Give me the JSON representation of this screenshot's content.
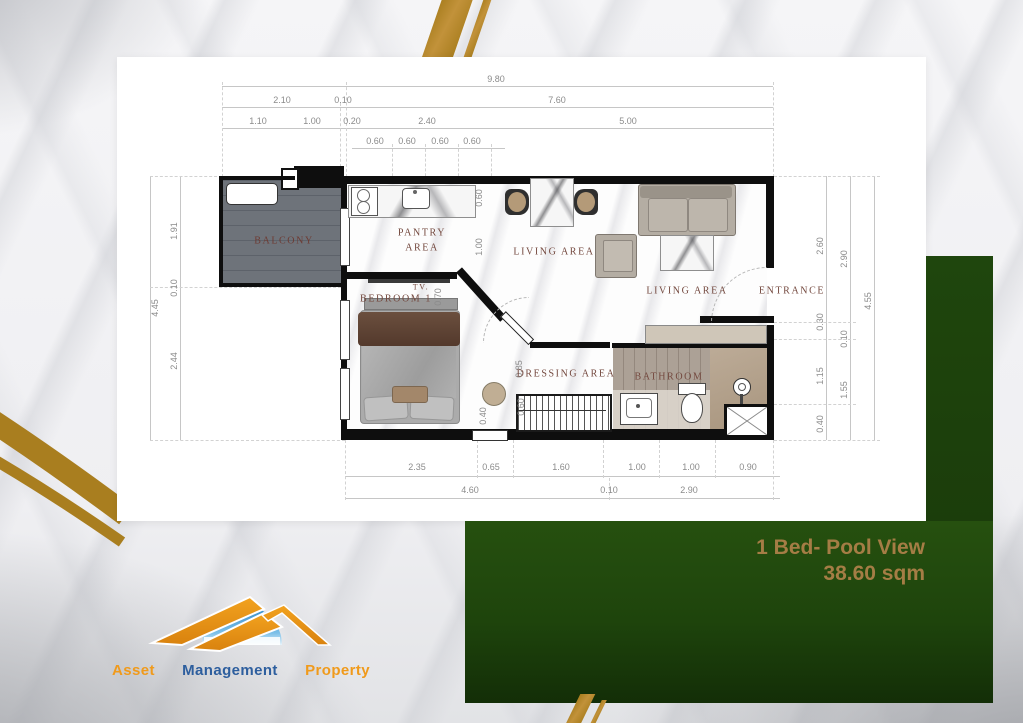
{
  "colors": {
    "gold": "#a97e1f",
    "green_dark": "#1e440c",
    "banner_text": "#a57d45",
    "label_text": "#74493f",
    "balcony_text": "#6d3b33",
    "logo_orange": "#f09a1b",
    "logo_blue": "#2d5e9e",
    "logo_sky": "#2f87c8"
  },
  "banner": {
    "line1": "1 Bed- Pool View",
    "line2": "38.60 sqm"
  },
  "logo": {
    "icon": "mountain-sun-logo",
    "words": [
      {
        "text": "Asset",
        "color": "#f09a1b"
      },
      {
        "text": "Management",
        "color": "#2d5e9e"
      },
      {
        "text": "Property",
        "color": "#f09a1b"
      }
    ]
  },
  "plan": {
    "dimensions": [
      {
        "v": "9.80",
        "x": 496,
        "y": 79,
        "vert": false
      },
      {
        "v": "2.10",
        "x": 282,
        "y": 100,
        "vert": false
      },
      {
        "v": "0.10",
        "x": 343,
        "y": 100,
        "vert": false
      },
      {
        "v": "7.60",
        "x": 557,
        "y": 100,
        "vert": false
      },
      {
        "v": "1.10",
        "x": 258,
        "y": 121,
        "vert": false
      },
      {
        "v": "1.00",
        "x": 312,
        "y": 121,
        "vert": false
      },
      {
        "v": "0.20",
        "x": 352,
        "y": 121,
        "vert": false
      },
      {
        "v": "2.40",
        "x": 427,
        "y": 121,
        "vert": false
      },
      {
        "v": "5.00",
        "x": 628,
        "y": 121,
        "vert": false
      },
      {
        "v": "0.60",
        "x": 375,
        "y": 141,
        "vert": false
      },
      {
        "v": "0.60",
        "x": 407,
        "y": 141,
        "vert": false
      },
      {
        "v": "0.60",
        "x": 440,
        "y": 141,
        "vert": false
      },
      {
        "v": "0.60",
        "x": 472,
        "y": 141,
        "vert": false
      },
      {
        "v": "4.45",
        "x": 155,
        "y": 308,
        "vert": true
      },
      {
        "v": "1.91",
        "x": 174,
        "y": 231,
        "vert": true
      },
      {
        "v": "0.10",
        "x": 174,
        "y": 288,
        "vert": true
      },
      {
        "v": "2.44",
        "x": 174,
        "y": 361,
        "vert": true
      },
      {
        "v": "2.60",
        "x": 820,
        "y": 246,
        "vert": true
      },
      {
        "v": "0.30",
        "x": 820,
        "y": 322,
        "vert": true
      },
      {
        "v": "1.15",
        "x": 820,
        "y": 376,
        "vert": true
      },
      {
        "v": "0.40",
        "x": 820,
        "y": 424,
        "vert": true
      },
      {
        "v": "2.90",
        "x": 844,
        "y": 259,
        "vert": true
      },
      {
        "v": "0.10",
        "x": 844,
        "y": 339,
        "vert": true
      },
      {
        "v": "1.55",
        "x": 844,
        "y": 390,
        "vert": true
      },
      {
        "v": "4.55",
        "x": 868,
        "y": 301,
        "vert": true
      },
      {
        "v": "2.35",
        "x": 417,
        "y": 467,
        "vert": false
      },
      {
        "v": "0.65",
        "x": 491,
        "y": 467,
        "vert": false
      },
      {
        "v": "1.60",
        "x": 561,
        "y": 467,
        "vert": false
      },
      {
        "v": "1.00",
        "x": 637,
        "y": 467,
        "vert": false
      },
      {
        "v": "1.00",
        "x": 691,
        "y": 467,
        "vert": false
      },
      {
        "v": "0.90",
        "x": 748,
        "y": 467,
        "vert": false
      },
      {
        "v": "4.60",
        "x": 470,
        "y": 490,
        "vert": false
      },
      {
        "v": "0.10",
        "x": 609,
        "y": 490,
        "vert": false
      },
      {
        "v": "2.90",
        "x": 689,
        "y": 490,
        "vert": false
      },
      {
        "v": "0.60",
        "x": 479,
        "y": 198,
        "vert": true
      },
      {
        "v": "1.00",
        "x": 479,
        "y": 247,
        "vert": true
      },
      {
        "v": "0.70",
        "x": 438,
        "y": 297,
        "vert": true
      },
      {
        "v": "0.85",
        "x": 519,
        "y": 369,
        "vert": true
      },
      {
        "v": "0.60",
        "x": 521,
        "y": 407,
        "vert": true
      },
      {
        "v": "0.40",
        "x": 483,
        "y": 416,
        "vert": true
      }
    ],
    "room_labels": [
      {
        "t": "BALCONY",
        "x": 284,
        "y": 241,
        "c": "#6d3b33",
        "fs": 10
      },
      {
        "t": "PANTRY",
        "x": 422,
        "y": 233,
        "fs": 10
      },
      {
        "t": "AREA",
        "x": 422,
        "y": 248,
        "fs": 10
      },
      {
        "t": "LIVING AREA",
        "x": 554,
        "y": 252,
        "fs": 10
      },
      {
        "t": "LIVING AREA",
        "x": 687,
        "y": 291,
        "fs": 10
      },
      {
        "t": "ENTRANCE",
        "x": 792,
        "y": 291,
        "fs": 10
      },
      {
        "t": "TV.",
        "x": 421,
        "y": 287,
        "fs": 8
      },
      {
        "t": "BEDROOM 1",
        "x": 396,
        "y": 299,
        "fs": 10
      },
      {
        "t": "DRESSING AREA",
        "x": 566,
        "y": 374,
        "fs": 10
      },
      {
        "t": "BATHROOM",
        "x": 669,
        "y": 377,
        "fs": 10
      }
    ]
  }
}
